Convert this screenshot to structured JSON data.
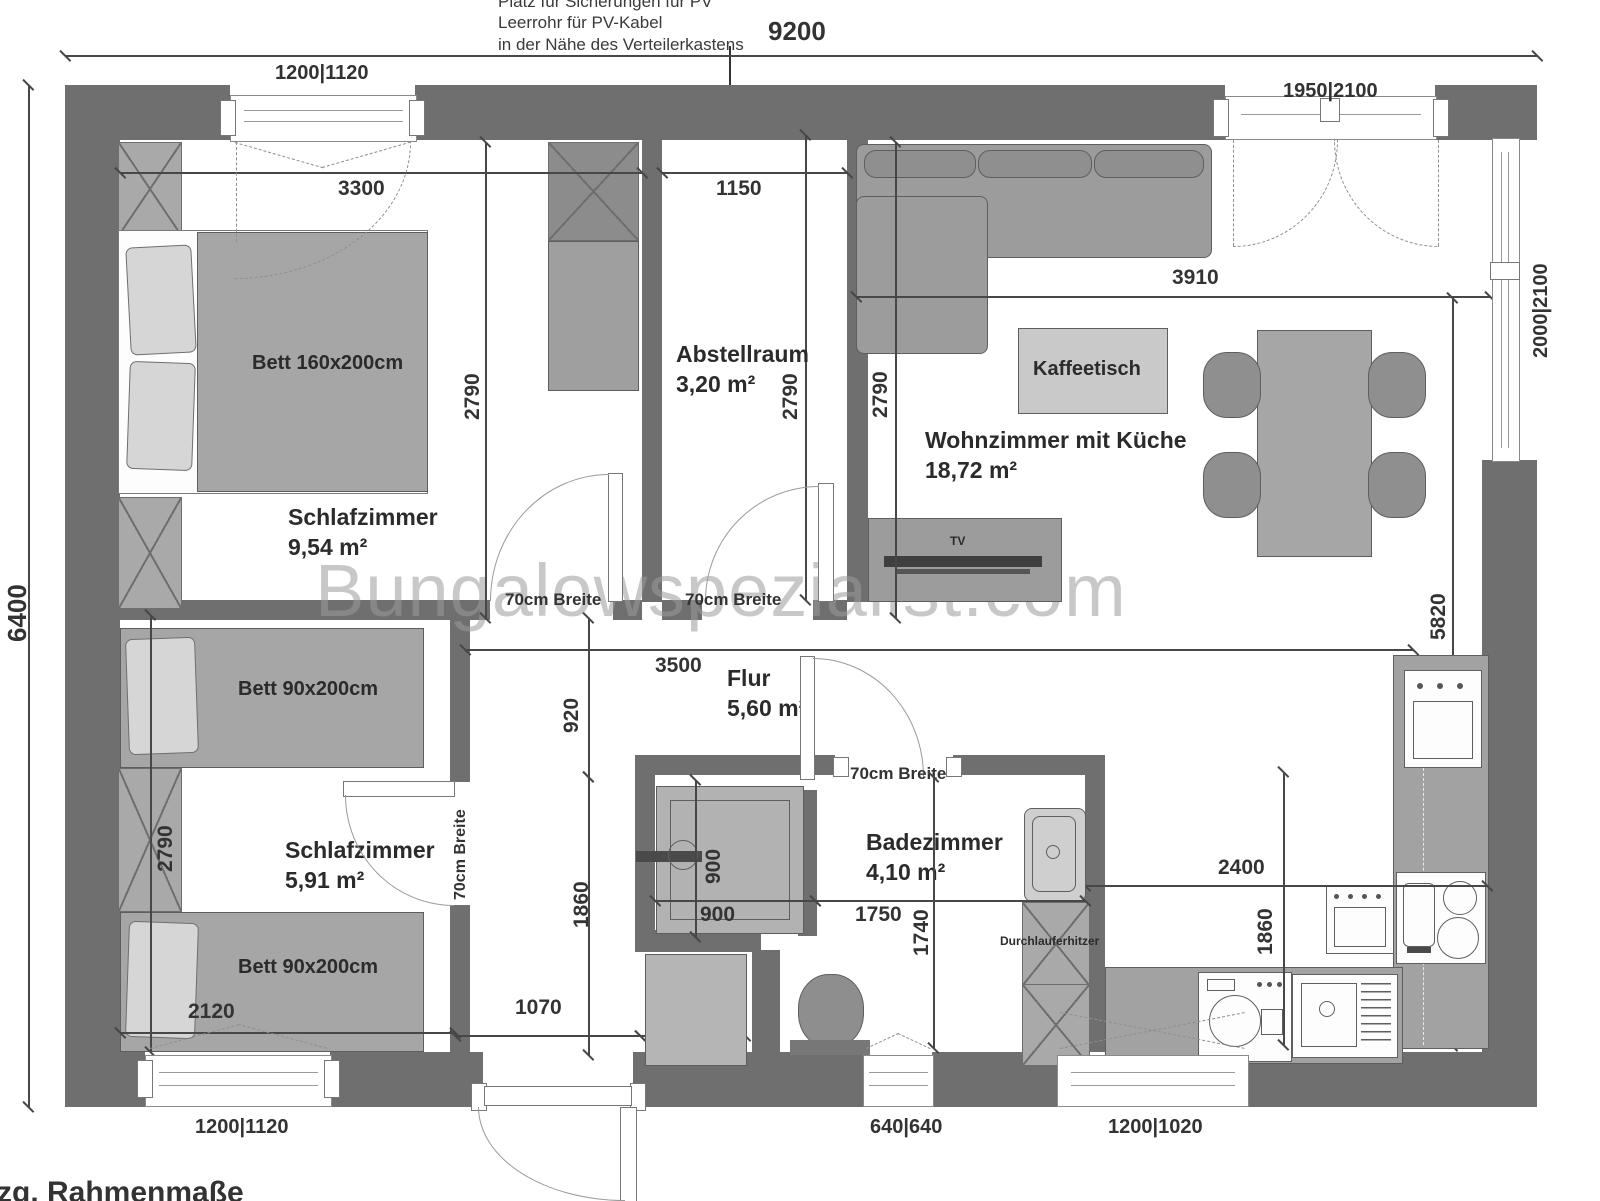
{
  "watermark": "Bungalowspezialist.com",
  "notes": {
    "pv1": "Platz für Sicherungen für PV",
    "pv2": "Leerrohr für PV-Kabel",
    "pv3": "in der Nähe des Verteilerkastens",
    "bottom": "zzg. Rahmenmaße"
  },
  "rooms": {
    "bedroom1": {
      "name": "Schlafzimmer",
      "area": "9,54 m²"
    },
    "storage": {
      "name": "Abstellraum",
      "area": "3,20 m²"
    },
    "living": {
      "name": "Wohnzimmer mit Küche",
      "area": "18,72 m²"
    },
    "hall": {
      "name": "Flur",
      "area": "5,60 m²"
    },
    "bath": {
      "name": "Badezimmer",
      "area": "4,10 m²"
    },
    "bedroom2": {
      "name": "Schlafzimmer",
      "area": "5,91 m²"
    }
  },
  "furniture": {
    "bed_double": "Bett 160x200cm",
    "bed_single1": "Bett 90x200cm",
    "bed_single2": "Bett 90x200cm",
    "coffee_table": "Kaffeetisch",
    "tv": "TV",
    "water_heater": "Durchlauferhitzer"
  },
  "door_note": "70cm Breite",
  "dims": {
    "total_w": "9200",
    "total_h": "6400",
    "bedroom1_w": "3300",
    "storage_w": "1150",
    "living_w": "3910",
    "bedroom1_d": "2790",
    "storage_d": "2790",
    "living_d": "2790",
    "bedroom2_d": "2790",
    "living_h": "5820",
    "hall_w": "3500",
    "hall_h1": "920",
    "hall_h2": "1860",
    "bedroom2_w": "2120",
    "entry_w": "1070",
    "closet_w": "600",
    "shower_w": "900",
    "shower_d": "900",
    "bath_w": "1750",
    "bath_d": "1740",
    "kitchen_w": "2400",
    "kitchen_d": "1860"
  },
  "windows": {
    "top_bedroom": "1200|1120",
    "terrace_door": "1950|2100",
    "side_living": "2000|2100",
    "bottom_bedroom": "1200|1120",
    "bath": "640|640",
    "kitchen": "1200|1020"
  }
}
